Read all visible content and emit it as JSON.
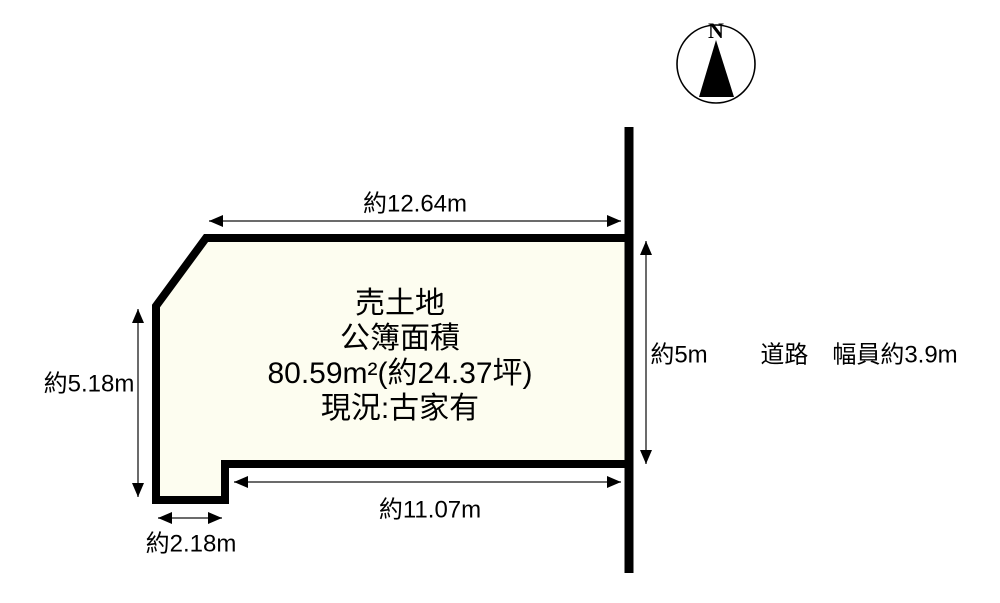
{
  "compass": {
    "north_label": "N"
  },
  "parcel": {
    "lines": [
      "売土地",
      "公簿面積",
      "80.59m²(約24.37坪)",
      "現況:古家有"
    ]
  },
  "dimensions": {
    "top": {
      "label": "約12.64m"
    },
    "left": {
      "label": "約5.18m"
    },
    "bottom": {
      "label": "約11.07m"
    },
    "bottom_left": {
      "label": "約2.18m"
    },
    "right": {
      "label": "約5m"
    }
  },
  "road": {
    "label": "道路　幅員約3.9m"
  },
  "colors": {
    "parcel_fill": "#FDFDF0",
    "outline": "#000000",
    "dim_line": "#3a3a3a"
  }
}
